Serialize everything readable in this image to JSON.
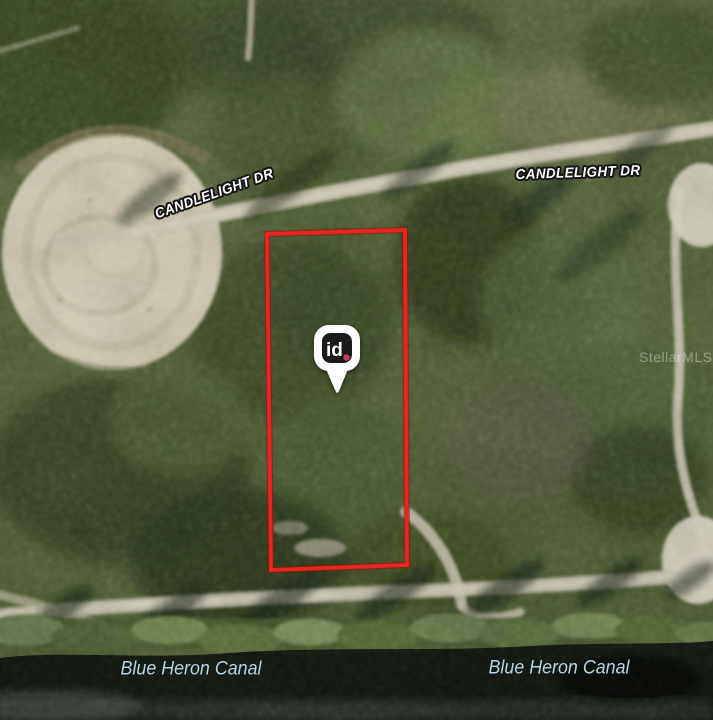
{
  "map": {
    "road_labels": [
      {
        "id": "candlelight-west",
        "text": "CANDLELIGHT DR"
      },
      {
        "id": "candlelight-east",
        "text": "CANDLELIGHT DR"
      }
    ],
    "water_labels": [
      {
        "id": "blue-heron-canal-west",
        "text": "Blue Heron Canal"
      },
      {
        "id": "blue-heron-canal-east",
        "text": "Blue Heron Canal"
      }
    ],
    "watermark_text": "StellarMLS",
    "pin": {
      "label": "id",
      "dot_color": "#c9395c",
      "body_color": "#1b1b1b",
      "outline_color": "#ffffff"
    },
    "colors": {
      "parcel_outline": "#e8261f",
      "road_label_fill": "#ffffff",
      "road_label_halo": "#151515",
      "water_label": "#b5d6e4"
    }
  }
}
